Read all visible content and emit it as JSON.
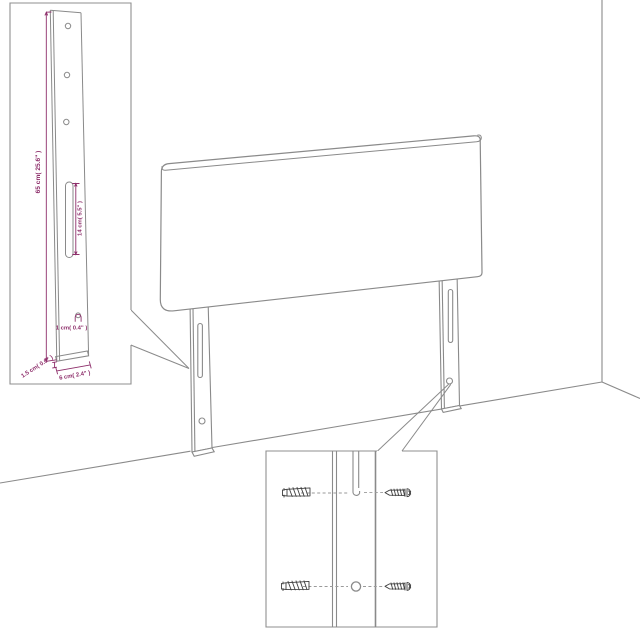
{
  "diagram": {
    "type": "product-assembly-diagram",
    "subject": "upholstered headboard with two mounting legs against a wall corner",
    "colors": {
      "line": "#8a8a8a",
      "box_border": "#8f8f8f",
      "dimension": "#8e2f6b",
      "hardware": "#3f3f3f",
      "background": "#ffffff"
    },
    "leg_detail_inset": {
      "name": "leg dimension detail",
      "dimensions": {
        "height": "65 cm( 25.6\" )",
        "slot_length": "14 cm( 5.5\" )",
        "hole_diameter": "1 cm( 0.4\" )",
        "thickness": "1.5 cm( 0.6\" )",
        "width": "6 cm( 2.4\" )"
      }
    },
    "hardware_inset": {
      "name": "screw and wall-plug mounting detail",
      "items": [
        "wall plug",
        "screw",
        "slot",
        "hole"
      ]
    }
  }
}
